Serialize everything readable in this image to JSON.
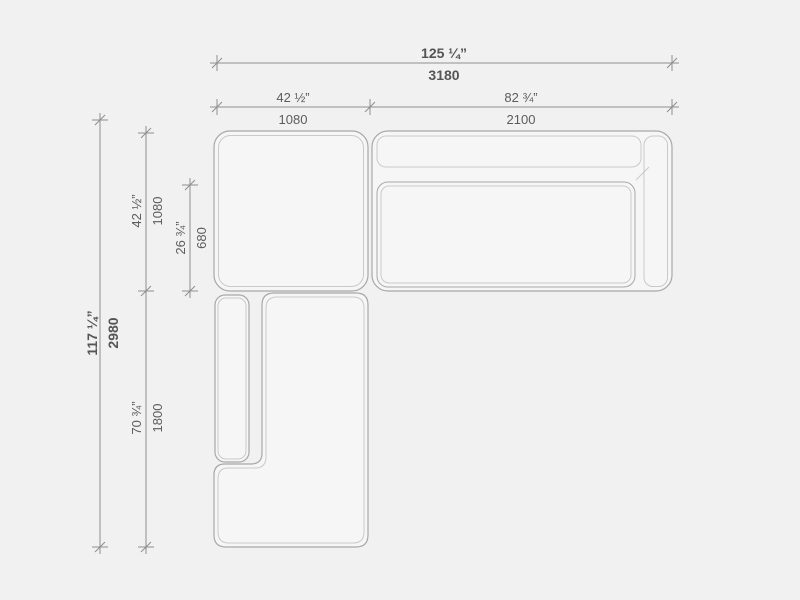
{
  "drawing": {
    "type": "sectional-sofa-plan-dimension-drawing",
    "background_color": "#f1f1f2",
    "module_fill": "#f6f6f7",
    "outline_color": "#a8a8a8",
    "inner_line_color": "#c9c9c9",
    "dimension_line_color": "#8f8f8f",
    "label_color": "#5c5c5c"
  },
  "dimensions": {
    "overall_width": {
      "imperial": "125 ¼”",
      "metric": "3180"
    },
    "corner_width": {
      "imperial": "42 ½”",
      "metric": "1080"
    },
    "sofa_width": {
      "imperial": "82 ¾”",
      "metric": "2100"
    },
    "overall_depth": {
      "imperial": "117 ¼”",
      "metric": "2980"
    },
    "corner_depth": {
      "imperial": "42 ½”",
      "metric": "1080"
    },
    "seat_depth": {
      "imperial": "26 ¾”",
      "metric": "680"
    },
    "chaise_length": {
      "imperial": "70 ¾”",
      "metric": "1800"
    }
  }
}
